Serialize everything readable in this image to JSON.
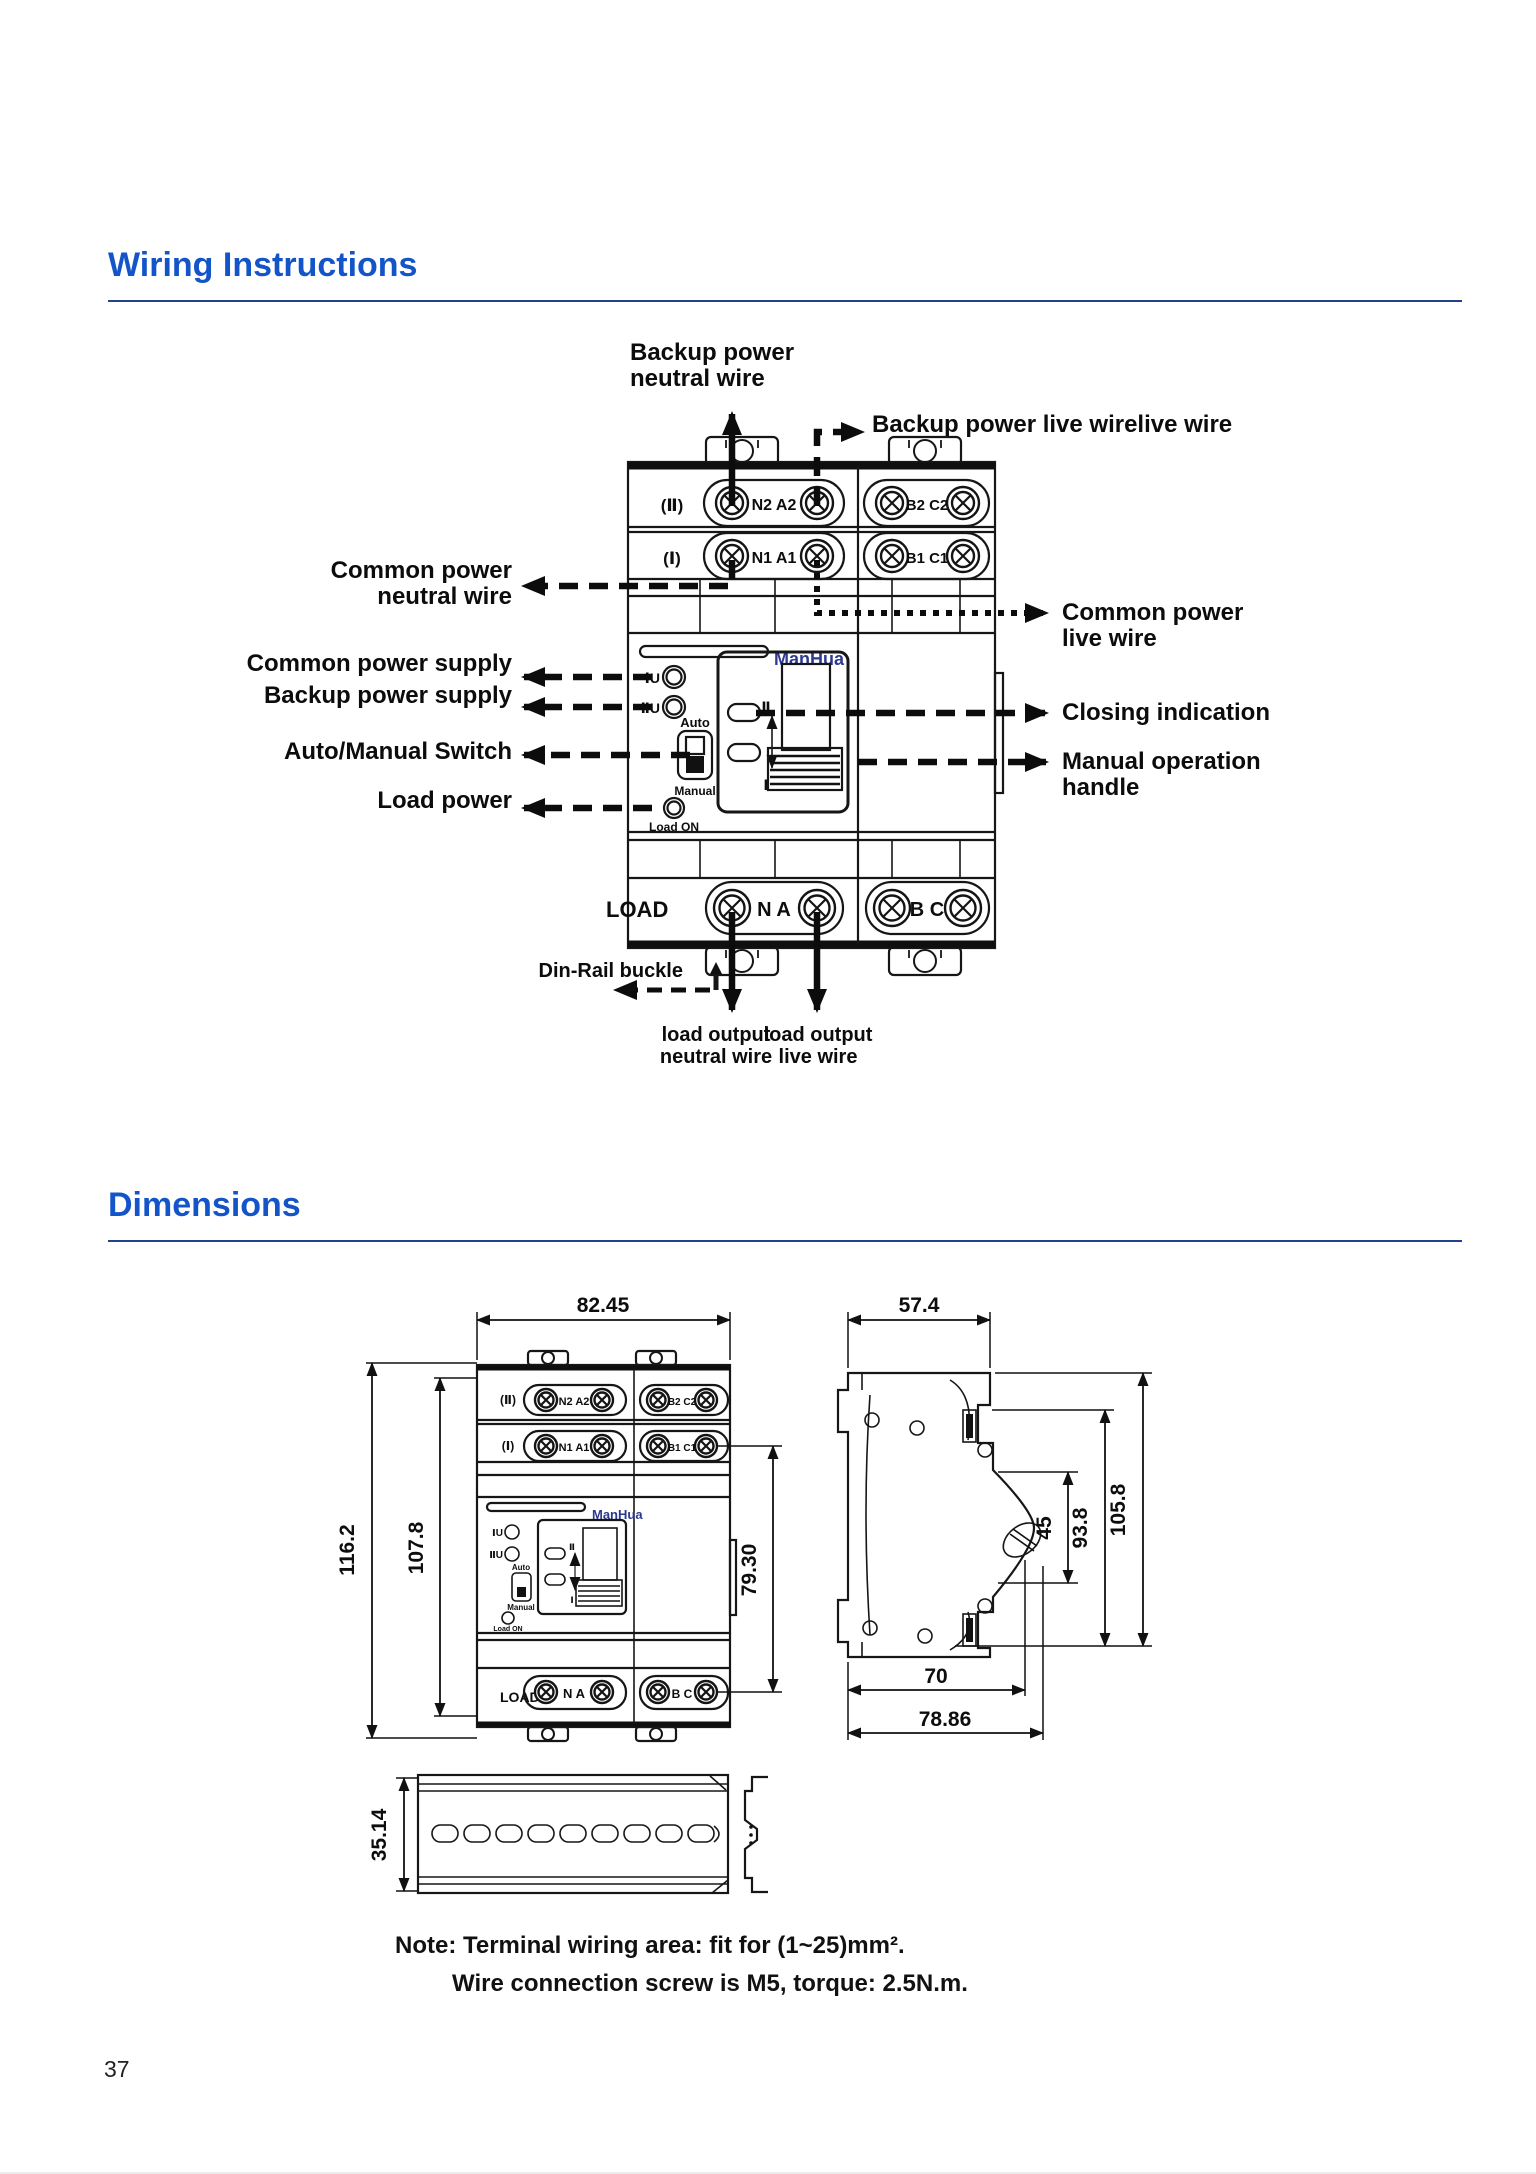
{
  "page": {
    "number": "37"
  },
  "sections": {
    "wiring_title": "Wiring Instructions",
    "dimensions_title": "Dimensions"
  },
  "colors": {
    "heading_blue": "#1355c8",
    "rule_navy": "#22418f",
    "brand_navy": "#2b3990",
    "ink": "#161616"
  },
  "wiring": {
    "labels": {
      "backup_neutral": [
        "Backup power",
        "neutral wire"
      ],
      "backup_live": "Backup power live wirelive wire",
      "common_neutral": [
        "Common power",
        "neutral wire"
      ],
      "common_supply": "Common power supply",
      "backup_supply": "Backup power supply",
      "auto_manual": "Auto/Manual Switch",
      "load_power": "Load power",
      "common_live": [
        "Common power",
        "live wire"
      ],
      "closing": "Closing indication",
      "manual_handle": [
        "Manual operation",
        "handle"
      ],
      "din_rail": "Din-Rail buckle",
      "load_out_neutral": [
        "load output",
        "neutral wire"
      ],
      "load_out_live": [
        "load output",
        "live wire"
      ]
    },
    "device": {
      "brand": "ManHua",
      "row2_label": "(Ⅱ)",
      "row2_left": "N2 A2",
      "row2_right": "B2 C2",
      "row1_label": "(Ⅰ)",
      "row1_left": "N1 A1",
      "row1_right": "B1 C1",
      "ind1": "ⅠU",
      "ind2": "ⅡU",
      "auto": "Auto",
      "manual": "Manual",
      "load_on": "Load ON",
      "pos2": "Ⅱ",
      "pos1": "Ⅰ",
      "load": "LOAD",
      "load_left": "N A",
      "load_right": "B C"
    }
  },
  "dimensions": {
    "front": {
      "width": "82.45",
      "height_outer": "116.2",
      "height_inner": "107.8",
      "height_right": "79.30"
    },
    "side": {
      "width": "57.4",
      "handle": "45",
      "inner": "93.8",
      "outer": "105.8",
      "depth": "70",
      "depth_total": "78.86"
    },
    "rail": {
      "height": "35.14"
    }
  },
  "note": {
    "line1": "Note: Terminal wiring area: fit for (1~25)mm².",
    "line2": "Wire connection screw is M5, torque: 2.5N.m."
  }
}
